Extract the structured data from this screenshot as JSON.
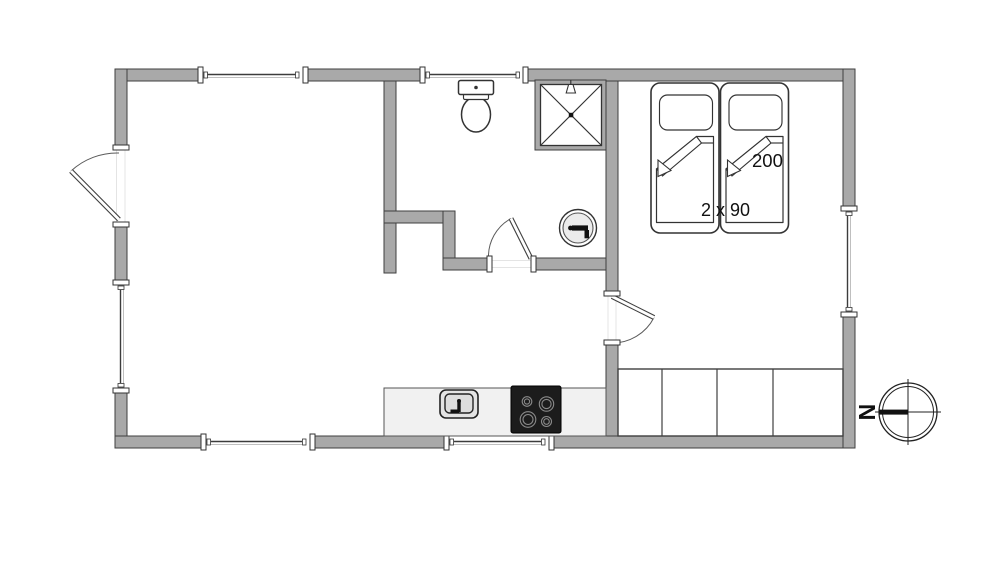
{
  "diagram": {
    "type": "floor-plan",
    "background": "#ffffff",
    "colors": {
      "wall_fill": "#a9a9a9",
      "wall_outline": "#3f3f3f",
      "fixture_outline": "#333333",
      "kitchen_counter": "#f1f1f1",
      "stove": "#1c1c1c"
    },
    "labels": {
      "bed_length": "200",
      "bed_width": "2 x 90",
      "compass_north": "N"
    },
    "fixtures": [
      "entrance-door",
      "bathroom-door",
      "bedroom-door",
      "window-top-left",
      "window-top-middle",
      "window-left",
      "window-right",
      "window-bottom-left",
      "window-bottom-middle",
      "toilet",
      "shower",
      "washbasin",
      "twin-beds",
      "pillows",
      "folded-duvets",
      "wardrobe",
      "kitchen-counter",
      "kitchen-sink",
      "stove",
      "compass-rose"
    ]
  }
}
